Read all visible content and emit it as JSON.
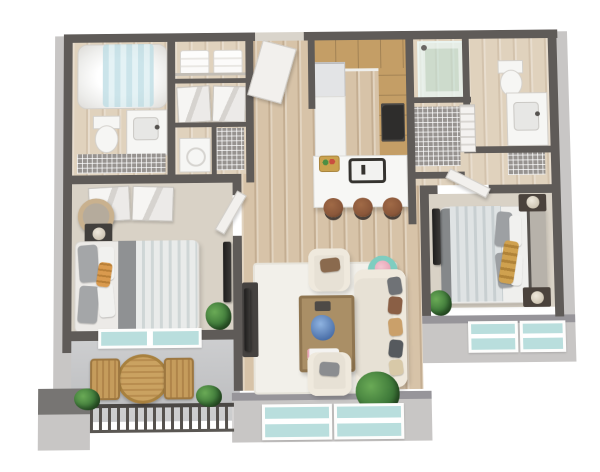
{
  "meta": {
    "title": "3D Floor Plan — Two Bedroom, Two Bath Apartment with Balcony",
    "view": "isometric top-down 3D render",
    "background": "#ffffff"
  },
  "palette": {
    "wall": "#5f5b58",
    "wallOuter": "#c8c6c5",
    "wallTop": "#97959a",
    "wood": "#d7c3a8",
    "woodLight": "#e0d2bd",
    "carpet": "#d9d2c6",
    "balcony": "#c4c5c7",
    "glass": "#b9dedd",
    "cabinet": "#c49e66",
    "counter": "#f1f1ef",
    "island": "#f7f7f5",
    "stool": "#8a573a",
    "sofa": "#e7e1d5",
    "sofaLight": "#efe9dd",
    "rug": "#f2f0ea",
    "tableWood": "#aa8f66",
    "teal": "#7fcdc0",
    "pink": "#e8a7b8",
    "plant": "#3f7a3a",
    "plantLight": "#6aaa56",
    "bedding": "#e9ebea",
    "stripe": "#cfd6d6",
    "blanket": "#8f9193",
    "pillow": "#a4a6a8",
    "orange": "#d99a4e",
    "gold": "#cfa14f",
    "dark": "#3c3a38",
    "fixture": "#f6f6f4",
    "wire": "#979390",
    "door": "#f2f0ed",
    "railing": "#4a4744",
    "outdoorWood": "#c59c5c",
    "headboard": "#b7b2aa"
  },
  "rooms": {
    "bathroom1": "Bathroom 1",
    "linenCloset": "Linen Closet",
    "closet1": "Hall Closet with Bifold Doors",
    "laundry": "Laundry Closet",
    "entry": "Entry Hallway",
    "kitchen": "Kitchen",
    "breakfastBar": "Breakfast Bar / Dining",
    "shower": "Walk-in Shower",
    "bathroom2": "Bathroom 2",
    "hallCloset": "Wire Shelf Closet",
    "linen2": "Linen Closet 2",
    "bedroom1": "Bedroom 1",
    "bedroom2": "Bedroom 2",
    "living": "Living Room",
    "balcony": "Balcony"
  },
  "labels": {
    "tub": "Bathtub with Shower Curtain",
    "toilet": "Toilet",
    "vanity": "Vanity with Sink",
    "washer": "Washer / Dryer",
    "towels": "Folded Towels",
    "bifold": "Bifold Closet Doors",
    "frontDoor": "Entry Door (open)",
    "fridge": "Refrigerator",
    "range": "Range / Stove",
    "cabinets": "Kitchen Cabinets",
    "island": "Kitchen Island Counter",
    "sink": "Island Sink",
    "fruit": "Fruit Basket",
    "stool": "Bar Stool",
    "sofa": "Sofa with Throw Pillows",
    "armchair": "Armchair",
    "coffee": "Coffee Table with Decor",
    "side": "Round Side Table with Flowers",
    "rug": "Area Rug",
    "console": "TV Console",
    "tv": "Wall-mounted TV",
    "bed": "Queen Bed",
    "nightstand": "Nightstand",
    "mirror": "Round Mirror / Basket",
    "plant": "Potted Plant",
    "patioTable": "Round Patio Table",
    "patioChair": "Patio Chair",
    "railing": "Balcony Railing",
    "window": "Window",
    "slider": "Sliding Glass Door",
    "column": "Concrete Column",
    "wireShelf": "Wire Shelving",
    "accordion": "Accordion Door",
    "door": "Interior Door (open)",
    "shelf": "Closet Shelf"
  }
}
